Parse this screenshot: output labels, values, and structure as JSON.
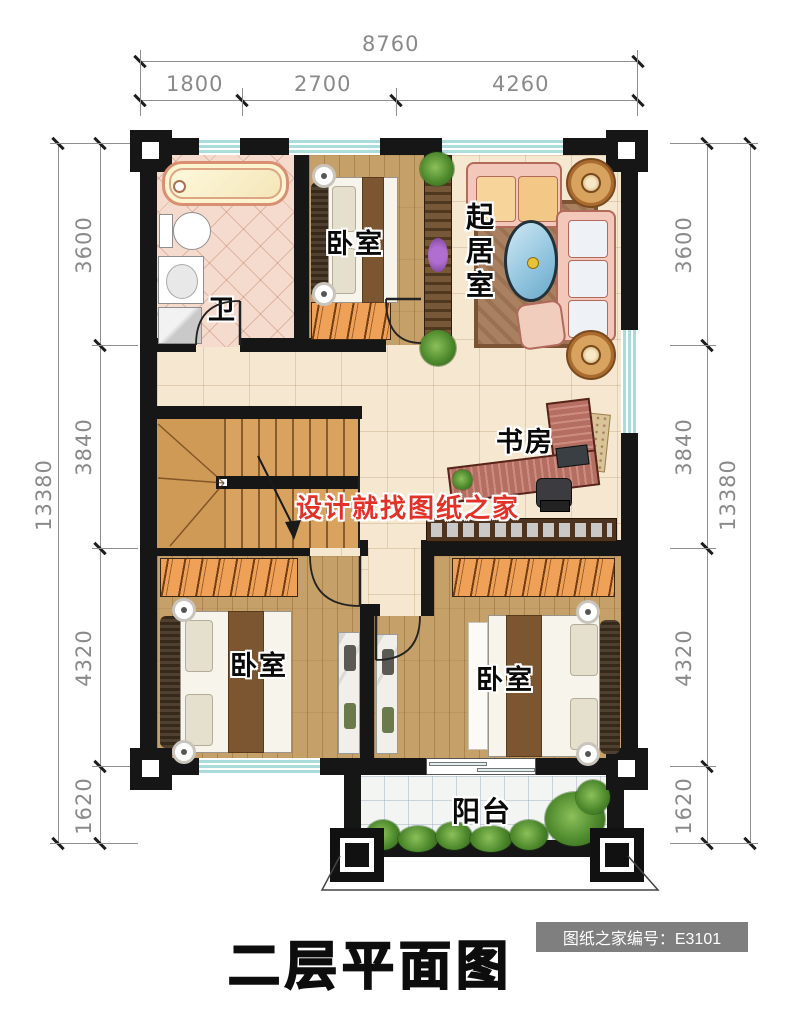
{
  "title": {
    "text": "二层平面图"
  },
  "badge": {
    "label": "图纸之家编号：E3101"
  },
  "watermark": {
    "text": "设计就找图纸之家"
  },
  "dimensions": {
    "top": {
      "total": "8760",
      "segments": [
        "1800",
        "2700",
        "4260"
      ]
    },
    "left": {
      "total": "13380",
      "segments": [
        "3600",
        "3840",
        "4320",
        "1620"
      ]
    },
    "right": {
      "total": "13380",
      "segments": [
        "3600",
        "3840",
        "4320",
        "1620"
      ]
    }
  },
  "rooms": {
    "bathroom": "卫",
    "bedroom_top": "卧室",
    "living_room": "起居室",
    "study": "书房",
    "bedroom_bottom_left": "卧室",
    "bedroom_bottom_right": "卧室",
    "balcony": "阳台"
  },
  "colors": {
    "wall": "#161616",
    "wood_floor": "#c6a069",
    "tile_floor": "#f6e8d0",
    "bath_tile": "#f4dbce",
    "window_glass": "#aadcdc",
    "wardrobe": "#efa257",
    "watermark_red": "#e23127",
    "badge_bg": "#7f7f7f"
  }
}
